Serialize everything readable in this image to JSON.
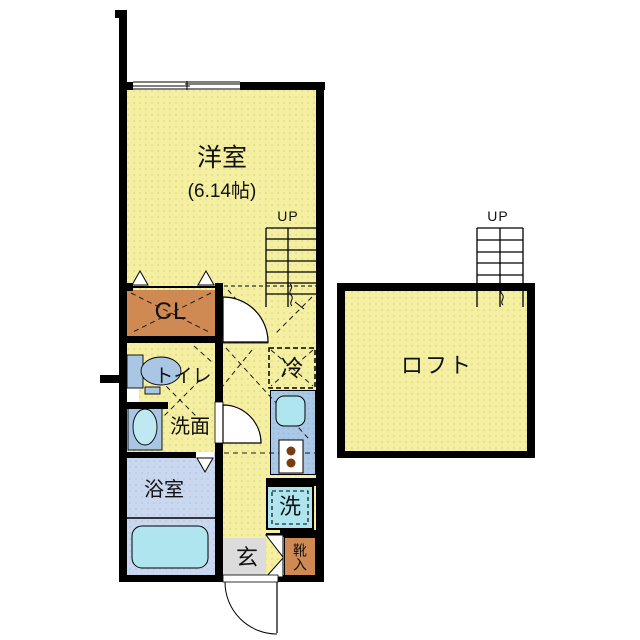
{
  "plan": {
    "rooms": {
      "western_room": {
        "name": "洋室",
        "area": "(6.14帖)"
      },
      "closet": {
        "name": "CL"
      },
      "toilet": {
        "name": "トイレ"
      },
      "washroom": {
        "name": "洗面"
      },
      "bathroom": {
        "name": "浴室"
      },
      "loft": {
        "name": "ロフト"
      },
      "entrance": {
        "name": "玄"
      },
      "shoe_cabinet": {
        "name": "靴入"
      }
    },
    "fixtures": {
      "refrigerator": {
        "name": "冷"
      },
      "washing_machine": {
        "name": "洗"
      }
    },
    "stairs": {
      "left_up_label": "UP",
      "right_up_label": "UP"
    },
    "colors": {
      "room_yellow": "#F5EFA2",
      "closet_orange": "#CE8A52",
      "fixture_blue": "#A9C7E5",
      "tub_cyan": "#AEE5EF",
      "bathroom_blue": "#C9D7EF",
      "kitchen_blue": "#A9C9E6",
      "entrance_gray": "#DCDCDC",
      "wall_black": "#000000",
      "burner_knob_brown": "#7A3B10"
    }
  }
}
